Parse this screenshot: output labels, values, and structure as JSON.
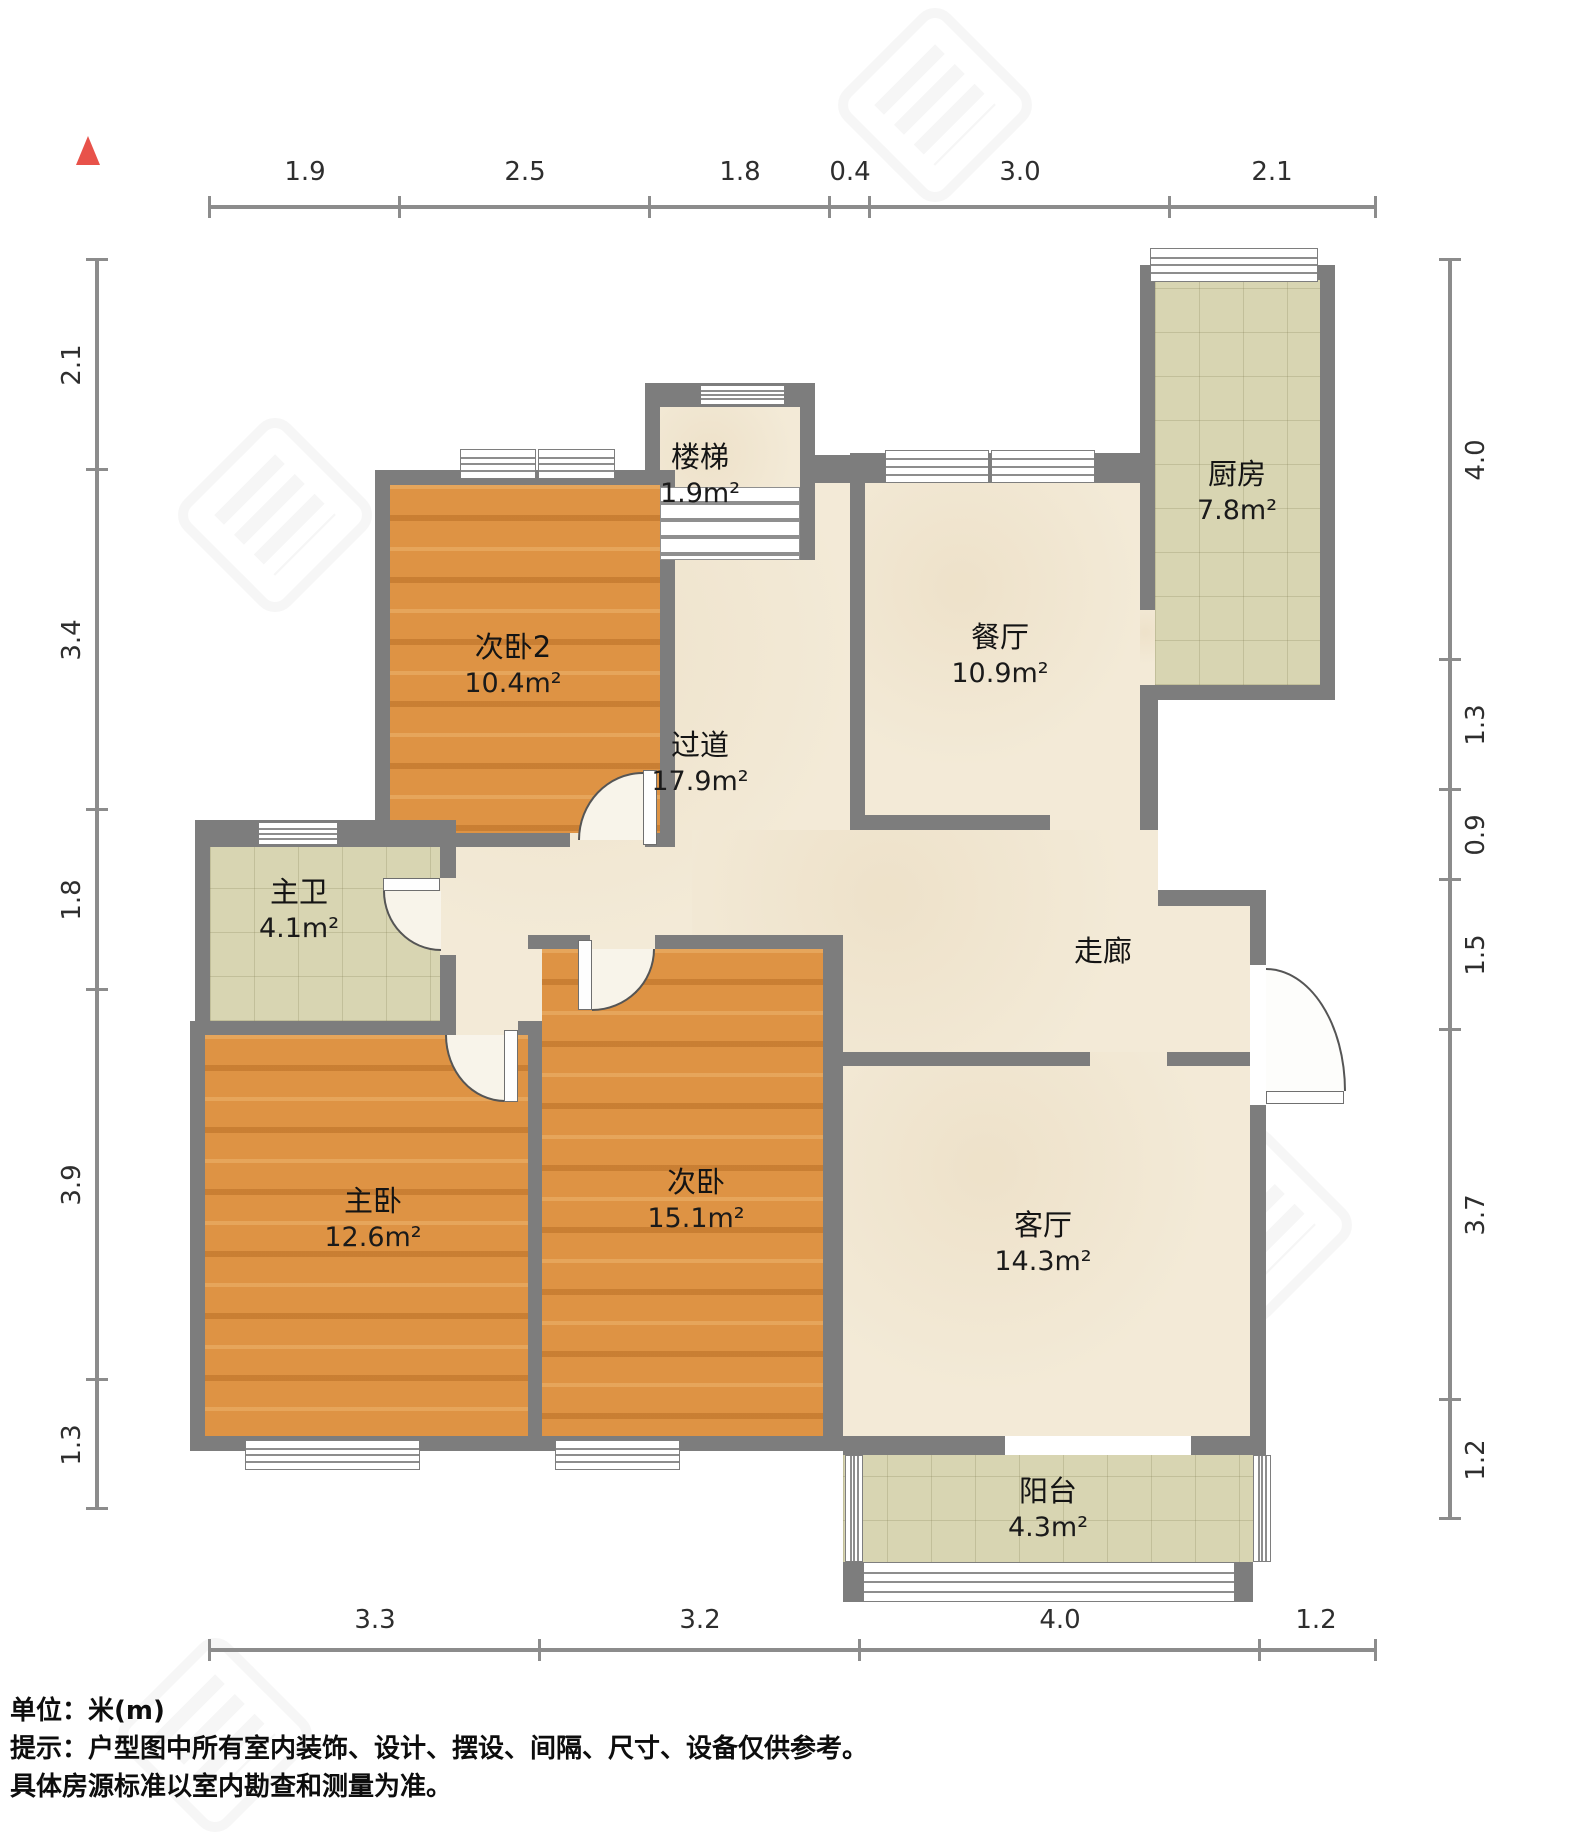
{
  "unit_label": "单位：米(m)",
  "notes": {
    "line1": "提示：户型图中所有室内装饰、设计、摆设、间隔、尺寸、设备仅供参考。",
    "line2": "具体房源标准以室内勘查和测量为准。"
  },
  "rooms": {
    "stairs": {
      "name": "楼梯",
      "area": "1.9m²"
    },
    "kitchen": {
      "name": "厨房",
      "area": "7.8m²"
    },
    "bedroom2": {
      "name": "次卧2",
      "area": "10.4m²"
    },
    "dining": {
      "name": "餐厅",
      "area": "10.9m²"
    },
    "hallway": {
      "name": "过道",
      "area": "17.9m²"
    },
    "master_bath": {
      "name": "主卫",
      "area": "4.1m²"
    },
    "corridor": {
      "name": "走廊",
      "area": ""
    },
    "master_bedroom": {
      "name": "主卧",
      "area": "12.6m²"
    },
    "bedroom": {
      "name": "次卧",
      "area": "15.1m²"
    },
    "living": {
      "name": "客厅",
      "area": "14.3m²"
    },
    "balcony": {
      "name": "阳台",
      "area": "4.3m²"
    }
  },
  "dimensions": {
    "top": [
      "1.9",
      "2.5",
      "1.8",
      "0.4",
      "3.0",
      "2.1"
    ],
    "left": [
      "2.1",
      "3.4",
      "1.8",
      "3.9",
      "1.3"
    ],
    "right": [
      "4.0",
      "1.3",
      "0.9",
      "1.5",
      "3.7",
      "1.2"
    ],
    "bottom": [
      "3.3",
      "3.2",
      "4.0",
      "1.2"
    ]
  },
  "colors": {
    "wall": "#7d7d7d",
    "wood_floor": "#de9344",
    "marble_floor": "#f3ead7",
    "tile_floor": "#d8d5b2",
    "north_marker": "#e8524a"
  }
}
